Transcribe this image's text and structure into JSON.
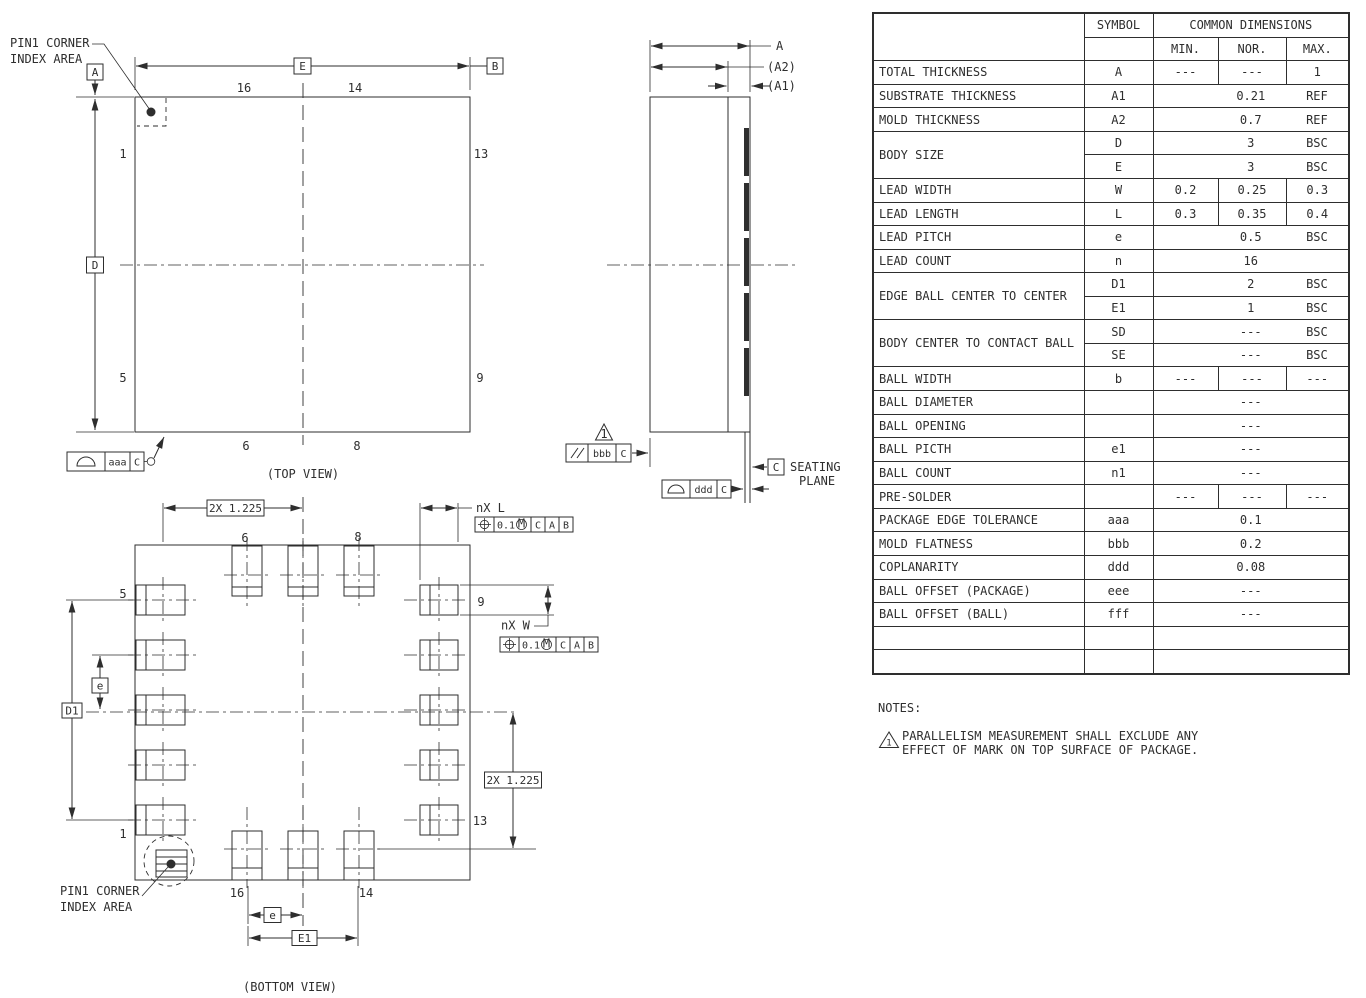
{
  "drawing": {
    "pin1_label": {
      "line1": "PIN1 CORNER",
      "line2": "INDEX AREA"
    },
    "captions": {
      "top": "(TOP VIEW)",
      "bottom": "(BOTTOM VIEW)"
    },
    "datums": {
      "a": "A",
      "b": "B",
      "c": "C",
      "d": "D",
      "e": "E"
    },
    "pins": {
      "p1": "1",
      "p5": "5",
      "p6": "6",
      "p8": "8",
      "p9": "9",
      "p13": "13",
      "p14": "14",
      "p16": "16"
    },
    "side_dims": {
      "total": "A",
      "mold": "(A2)",
      "substrate": "(A1)"
    },
    "seating": {
      "datum": "C",
      "label1": "SEATING",
      "label2": "PLANE"
    },
    "fcf": {
      "profile_tol_top": "aaa",
      "parallel_tol": "bbb",
      "parallel_flag": "1",
      "coplanarity_tol": "ddd",
      "datum_c": "C",
      "pos_tol": "0.1",
      "pos_mod": "M",
      "pos_d1": "C",
      "pos_d2": "A",
      "pos_d3": "B"
    },
    "dims": {
      "half_pitch": "2X 1.225",
      "lead_length": "nX L",
      "lead_width": "nX W",
      "pitch": "e",
      "ball_span_x": "E1",
      "ball_span_y": "D1"
    }
  },
  "dim_table": {
    "header": {
      "symbol": "SYMBOL",
      "common": "COMMON DIMENSIONS",
      "min": "MIN.",
      "nor": "NOR.",
      "max": "MAX."
    },
    "rows": [
      {
        "name": "TOTAL THICKNESS",
        "symbol": "A",
        "min": "---",
        "nor": "---",
        "max": "1"
      },
      {
        "name": "SUBSTRATE THICKNESS",
        "symbol": "A1",
        "value": "0.21",
        "suffix": "REF"
      },
      {
        "name": "MOLD THICKNESS",
        "symbol": "A2",
        "value": "0.7",
        "suffix": "REF"
      },
      {
        "name": "BODY SIZE",
        "symbol": "D",
        "value": "3",
        "suffix": "BSC"
      },
      {
        "symbol": "E",
        "value": "3",
        "suffix": "BSC"
      },
      {
        "name": "LEAD WIDTH",
        "symbol": "W",
        "min": "0.2",
        "nor": "0.25",
        "max": "0.3"
      },
      {
        "name": "LEAD LENGTH",
        "symbol": "L",
        "min": "0.3",
        "nor": "0.35",
        "max": "0.4"
      },
      {
        "name": "LEAD PITCH",
        "symbol": "e",
        "value": "0.5",
        "suffix": "BSC"
      },
      {
        "name": "LEAD COUNT",
        "symbol": "n",
        "value": "16"
      },
      {
        "name": "EDGE BALL CENTER TO CENTER",
        "symbol": "D1",
        "value": "2",
        "suffix": "BSC"
      },
      {
        "symbol": "E1",
        "value": "1",
        "suffix": "BSC"
      },
      {
        "name": "BODY CENTER TO CONTACT BALL",
        "symbol": "SD",
        "value": "---",
        "suffix": "BSC"
      },
      {
        "symbol": "SE",
        "value": "---",
        "suffix": "BSC"
      },
      {
        "name": "BALL WIDTH",
        "symbol": "b",
        "min": "---",
        "nor": "---",
        "max": "---"
      },
      {
        "name": "BALL DIAMETER",
        "symbol": "",
        "value": "---"
      },
      {
        "name": "BALL OPENING",
        "symbol": "",
        "value": "---"
      },
      {
        "name": "BALL PICTH",
        "symbol": "e1",
        "value": "---"
      },
      {
        "name": "BALL COUNT",
        "symbol": "n1",
        "value": "---"
      },
      {
        "name": "PRE-SOLDER",
        "symbol": "",
        "min": "---",
        "nor": "---",
        "max": "---"
      },
      {
        "name": "PACKAGE EDGE TOLERANCE",
        "symbol": "aaa",
        "value": "0.1"
      },
      {
        "name": "MOLD FLATNESS",
        "symbol": "bbb",
        "value": "0.2"
      },
      {
        "name": "COPLANARITY",
        "symbol": "ddd",
        "value": "0.08"
      },
      {
        "name": "BALL OFFSET (PACKAGE)",
        "symbol": "eee",
        "value": "---"
      },
      {
        "name": "BALL OFFSET (BALL)",
        "symbol": "fff",
        "value": "---"
      }
    ]
  },
  "notes": {
    "title": "NOTES:",
    "flag": "1",
    "line1": "PARALLELISM MEASUREMENT SHALL EXCLUDE ANY",
    "line2": "EFFECT OF MARK ON TOP SURFACE OF PACKAGE."
  }
}
